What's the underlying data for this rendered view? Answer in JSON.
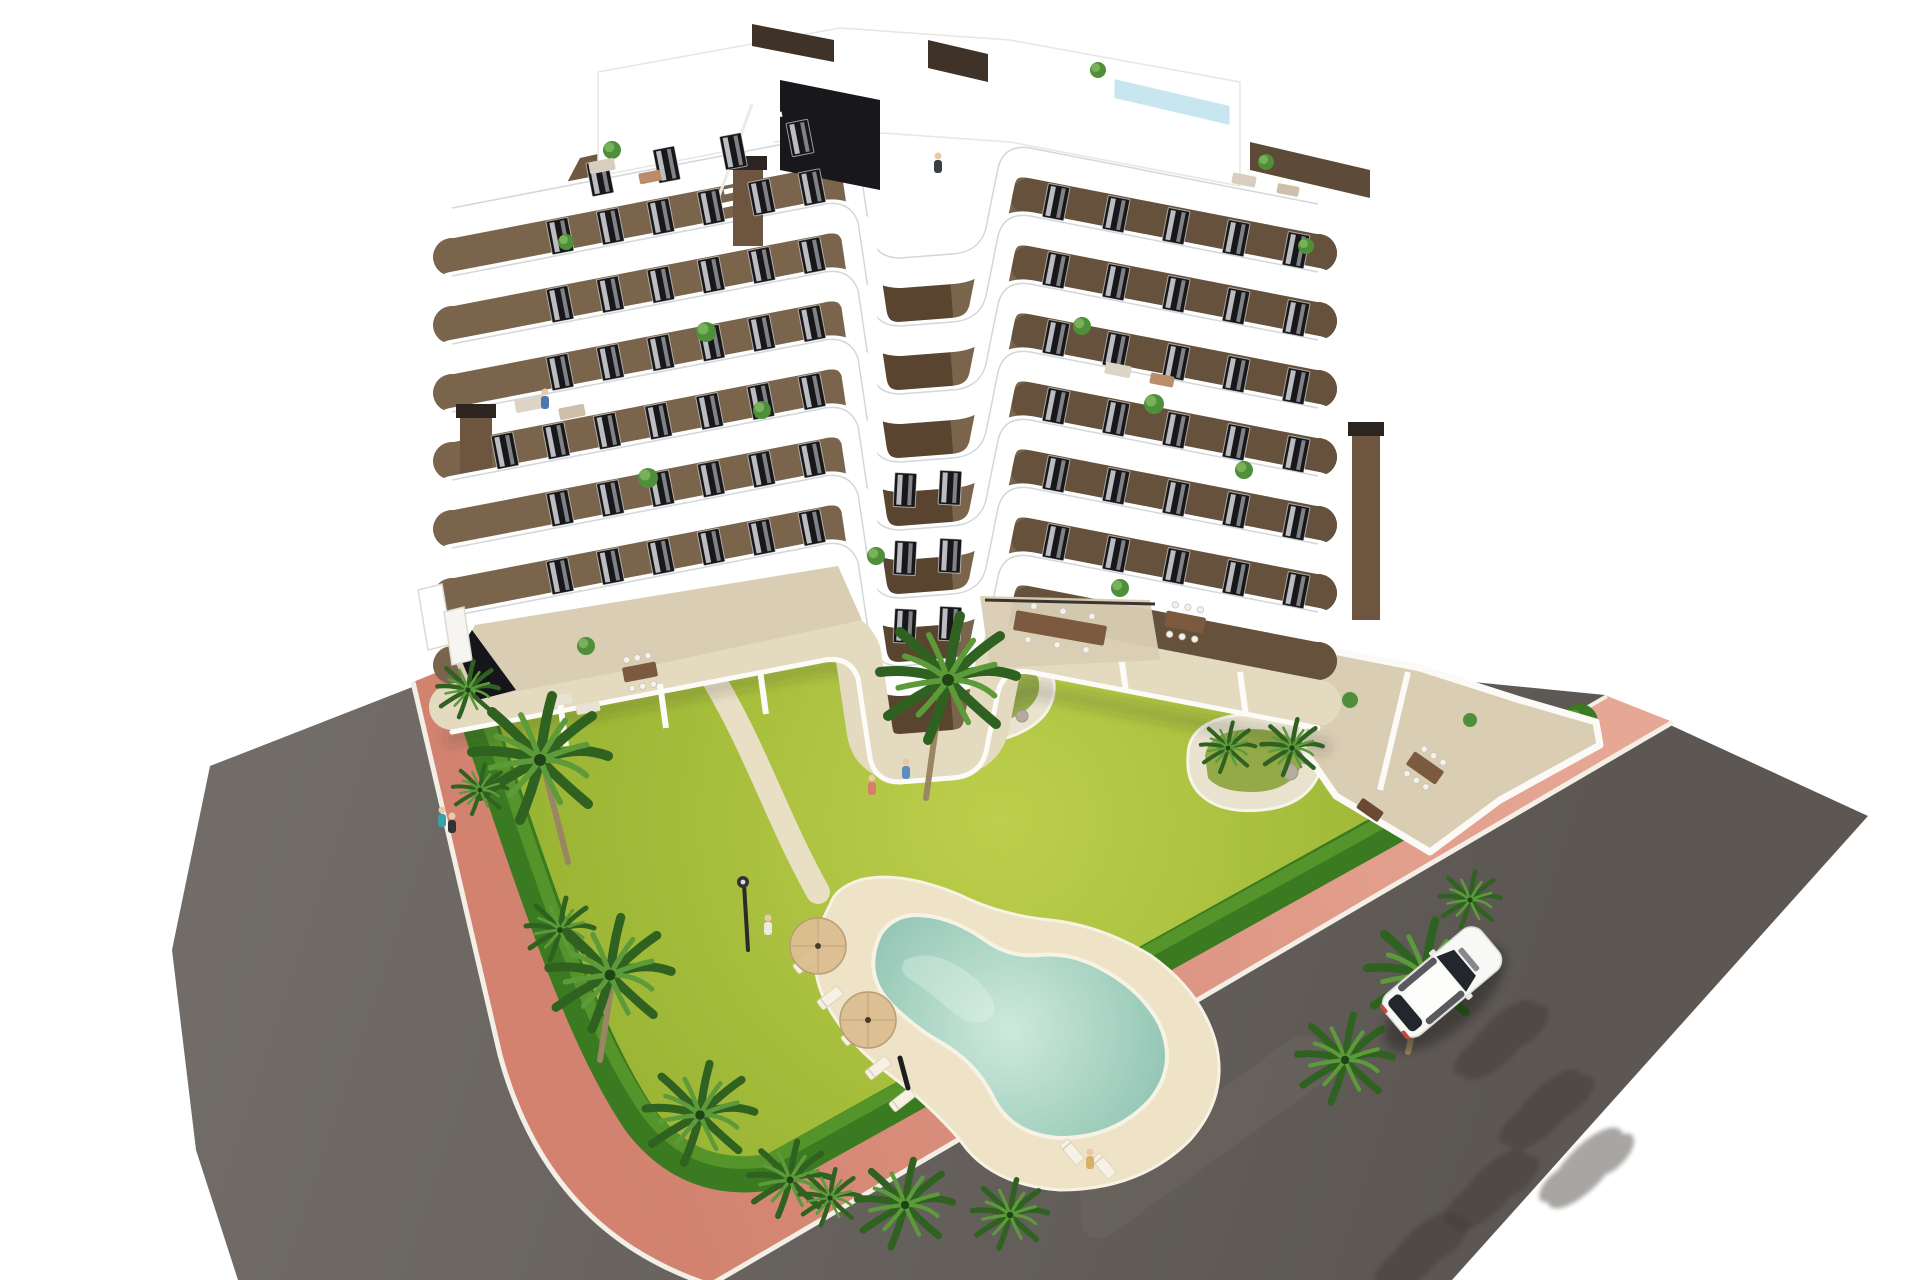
{
  "scene": {
    "description": "Aerial oblique 3D architectural rendering of a modern 7-storey apartment residence with stacked white curved balcony bands and brown facades, rooftop terrace with plunge pool and stair bulkhead, landscaped corner plot with lawn, palm trees, free-form swimming pool with sun deck, pink paved perimeter sidewalk, asphalt streets and a single white car",
    "background": "white",
    "view": "top-down oblique CGI render"
  },
  "palette": {
    "asphalt_light": "#716c67",
    "asphalt_dark": "#5c5753",
    "sidewalk_light": "#e7a795",
    "sidewalk_dark": "#d2826f",
    "curb_white": "#f3efe7",
    "lawn_light": "#bccf4c",
    "lawn_dark": "#8fab2b",
    "hedge_green": "#3a7a20",
    "hedge_light": "#5d9b2e",
    "palm_dark": "#2f6220",
    "palm_light": "#5d9b3a",
    "trunk_tan": "#9b8663",
    "water_light": "#cde9dc",
    "water_dark": "#8ac0ae",
    "pool_deck": "#eee3c6",
    "stone_edge": "#e9e2cf",
    "tile_beige": "#d9cdb3",
    "terrace_sand": "#e4dac0",
    "wall_front": "#7a644c",
    "wall_side": "#66513c",
    "wall_inner": "#59452f",
    "wall_back": "#6f5942",
    "band_white": "#ffffff",
    "railing_glass": "rgba(150,168,180,0.45)",
    "window_dark": "#17171b",
    "curtain": "#d9dbdd",
    "roof_pool_blue": "#c8e6f0",
    "bulkhead_dark": "#17171c",
    "chimney_brown": "#6d553f",
    "chimney_cap": "#2c2420",
    "car_body": "#f8f8f6",
    "car_glass": "#23262c",
    "car_taillight": "#c4483c",
    "shadow": "#3f3a36",
    "umbrella_tan": "#dcbf92",
    "furniture_wood": "#7b5a3f",
    "rock_gray": "#b4ac9e",
    "skin": "#e8c9a8"
  },
  "building": {
    "floors": 7,
    "chimneys": 3,
    "rooftop": {
      "plunge_pool": true,
      "stair_bulkhead": true,
      "accent_walls": 3
    },
    "geometry": {
      "front_edge": "M452,442 L820,371 Q849,364 858,388 L870,468 Q875,492 900,492 L952,488 Q980,486 986,462 L998,402 Q1004,378 1030,382 L1318,438",
      "courtyard_edge": "M858,388 L870,468 Q875,492 900,492 L952,488",
      "right_wing_edge": "M1030,382 L1318,438",
      "floor_step": 68,
      "band_width": 34,
      "wall_width": 38
    },
    "window_runs": [
      {
        "name": "left-wing",
        "x_start": 560,
        "x_end": 812,
        "count": 6,
        "rot": -11,
        "floors": [
          0,
          1,
          2,
          4,
          5
        ],
        "x0": 452,
        "y0": 442,
        "slope": -0.193
      },
      {
        "name": "left-terrace-floor",
        "x_start": 505,
        "x_end": 812,
        "count": 7,
        "rot": -11,
        "floors": [
          3
        ],
        "x0": 452,
        "y0": 442,
        "slope": -0.193
      },
      {
        "name": "right-wing",
        "x_start": 1056,
        "x_end": 1296,
        "count": 5,
        "rot": 11,
        "floors": [
          0,
          1,
          2,
          3,
          4,
          5
        ],
        "x0": 1030,
        "y0": 382,
        "slope": 0.2
      },
      {
        "name": "courtyard-face",
        "x_start": 905,
        "x_end": 950,
        "count": 2,
        "rot": 3,
        "floors": [
          3,
          4,
          5
        ],
        "x0": 905,
        "y0": 471,
        "slope": -0.05
      },
      {
        "name": "back-facade",
        "x_start": 600,
        "x_end": 800,
        "count": 4,
        "rot": -11,
        "floors": [],
        "fixed": true,
        "x0": 600,
        "y0": 178,
        "slope": -0.2
      }
    ],
    "balcony_plants": [
      {
        "x": 706,
        "y": 332,
        "r": 10
      },
      {
        "x": 762,
        "y": 410,
        "r": 9
      },
      {
        "x": 648,
        "y": 478,
        "r": 10
      },
      {
        "x": 876,
        "y": 556,
        "r": 9
      },
      {
        "x": 1082,
        "y": 326,
        "r": 9
      },
      {
        "x": 1154,
        "y": 404,
        "r": 10
      },
      {
        "x": 1244,
        "y": 470,
        "r": 9
      },
      {
        "x": 566,
        "y": 242,
        "r": 8
      },
      {
        "x": 1306,
        "y": 246,
        "r": 8
      },
      {
        "x": 586,
        "y": 646,
        "r": 9
      },
      {
        "x": 1120,
        "y": 588,
        "r": 9
      },
      {
        "x": 612,
        "y": 150,
        "r": 9
      },
      {
        "x": 1098,
        "y": 70,
        "r": 8
      },
      {
        "x": 1266,
        "y": 162,
        "r": 8
      }
    ],
    "furniture": [
      {
        "x": 530,
        "y": 404,
        "w": 30,
        "h": 13,
        "rot": -11,
        "c": "#ddd4c6"
      },
      {
        "x": 572,
        "y": 412,
        "w": 26,
        "h": 12,
        "rot": -11,
        "c": "#cdbfa9"
      },
      {
        "x": 602,
        "y": 166,
        "w": 26,
        "h": 12,
        "rot": -11,
        "c": "#d8cec0"
      },
      {
        "x": 650,
        "y": 177,
        "w": 22,
        "h": 11,
        "rot": -11,
        "c": "#b98d6b"
      },
      {
        "x": 1244,
        "y": 180,
        "w": 24,
        "h": 11,
        "rot": 11,
        "c": "#d8cec0"
      },
      {
        "x": 1288,
        "y": 190,
        "w": 22,
        "h": 10,
        "rot": 11,
        "c": "#cdbfa9"
      },
      {
        "x": 1118,
        "y": 370,
        "w": 26,
        "h": 12,
        "rot": 11,
        "c": "#ddd4c6"
      },
      {
        "x": 1162,
        "y": 380,
        "w": 24,
        "h": 11,
        "rot": 11,
        "c": "#b98d6b"
      },
      {
        "x": 640,
        "y": 672,
        "w": 34,
        "h": 15,
        "rot": -11,
        "c": "#7b5a3f",
        "dots": true
      },
      {
        "x": 1185,
        "y": 622,
        "w": 40,
        "h": 16,
        "rot": 11,
        "c": "#7b5a3f",
        "dots": true
      },
      {
        "x": 1060,
        "y": 628,
        "w": 92,
        "h": 20,
        "rot": 10,
        "c": "#7b5a3f",
        "dots": true
      },
      {
        "x": 1425,
        "y": 768,
        "w": 36,
        "h": 16,
        "rot": 35,
        "c": "#7b5a3f",
        "dots": true
      },
      {
        "x": 560,
        "y": 700,
        "w": 24,
        "h": 10,
        "rot": -11,
        "c": "#e8e2d4"
      },
      {
        "x": 588,
        "y": 708,
        "w": 24,
        "h": 10,
        "rot": -11,
        "c": "#e8e2d4"
      },
      {
        "x": 1370,
        "y": 810,
        "w": 26,
        "h": 12,
        "rot": 35,
        "c": "#6b4a33"
      }
    ]
  },
  "garden": {
    "palms": [
      {
        "x": 468,
        "y": 690,
        "s": 0.9
      },
      {
        "x": 540,
        "y": 760,
        "s": 2.0
      },
      {
        "x": 480,
        "y": 790,
        "s": 0.8
      },
      {
        "x": 560,
        "y": 930,
        "s": 1.0
      },
      {
        "x": 610,
        "y": 975,
        "s": 1.8
      },
      {
        "x": 700,
        "y": 1115,
        "s": 1.6
      },
      {
        "x": 790,
        "y": 1180,
        "s": 1.2
      },
      {
        "x": 905,
        "y": 1205,
        "s": 1.4
      },
      {
        "x": 1010,
        "y": 1215,
        "s": 1.1
      },
      {
        "x": 830,
        "y": 1198,
        "s": 0.9
      },
      {
        "x": 1345,
        "y": 1060,
        "s": 1.4
      },
      {
        "x": 1425,
        "y": 975,
        "s": 1.7
      },
      {
        "x": 1470,
        "y": 900,
        "s": 0.9
      },
      {
        "x": 948,
        "y": 680,
        "s": 2.0
      },
      {
        "x": 1228,
        "y": 748,
        "s": 0.8
      },
      {
        "x": 1292,
        "y": 748,
        "s": 0.9
      }
    ],
    "palm_trunks": [
      [
        545,
        772,
        568,
        862
      ],
      [
        940,
        698,
        926,
        798
      ],
      [
        612,
        982,
        600,
        1060
      ],
      [
        1424,
        982,
        1408,
        1052
      ]
    ],
    "lamp": {
      "x": 744,
      "y": 884
    },
    "rocks": [
      {
        "x": 1002,
        "y": 702,
        "r": 8
      },
      {
        "x": 1022,
        "y": 716,
        "r": 6
      },
      {
        "x": 986,
        "y": 722,
        "r": 5
      },
      {
        "x": 1290,
        "y": 772,
        "r": 8
      },
      {
        "x": 1306,
        "y": 758,
        "r": 6
      }
    ]
  },
  "pool": {
    "type": "free-form lagoon",
    "loungers": [
      {
        "x": 806,
        "y": 962,
        "rot": -38
      },
      {
        "x": 830,
        "y": 998,
        "rot": -38
      },
      {
        "x": 854,
        "y": 1034,
        "rot": -38
      },
      {
        "x": 878,
        "y": 1068,
        "rot": -38
      },
      {
        "x": 902,
        "y": 1100,
        "rot": -38
      },
      {
        "x": 1072,
        "y": 1152,
        "rot": 50
      },
      {
        "x": 1104,
        "y": 1166,
        "rot": 50
      }
    ],
    "umbrellas": [
      {
        "x": 818,
        "y": 946,
        "r": 28
      },
      {
        "x": 868,
        "y": 1020,
        "r": 28
      }
    ],
    "closed_umbrella": {
      "x1": 900,
      "y1": 1058,
      "x2": 908,
      "y2": 1088
    }
  },
  "roads": {
    "tree_shadows": [
      {
        "x": 1500,
        "y": 1040
      },
      {
        "x": 1545,
        "y": 1110
      },
      {
        "x": 1490,
        "y": 1190
      },
      {
        "x": 1420,
        "y": 1252
      },
      {
        "x": 1585,
        "y": 1168
      }
    ]
  },
  "car": {
    "color": "white",
    "x": 1442,
    "y": 982,
    "angle": -40,
    "length": 126,
    "width": 53
  },
  "people": [
    {
      "x": 768,
      "y": 928,
      "c": "#eeeae2"
    },
    {
      "x": 545,
      "y": 402,
      "c": "#4a79b0"
    },
    {
      "x": 938,
      "y": 166,
      "c": "#3a3f46"
    },
    {
      "x": 872,
      "y": 788,
      "c": "#d87f6a"
    },
    {
      "x": 906,
      "y": 772,
      "c": "#5b8fc0"
    },
    {
      "x": 442,
      "y": 820,
      "c": "#3aa0a8"
    },
    {
      "x": 452,
      "y": 826,
      "c": "#30343a"
    },
    {
      "x": 1090,
      "y": 1162,
      "c": "#d8b06a"
    }
  ]
}
